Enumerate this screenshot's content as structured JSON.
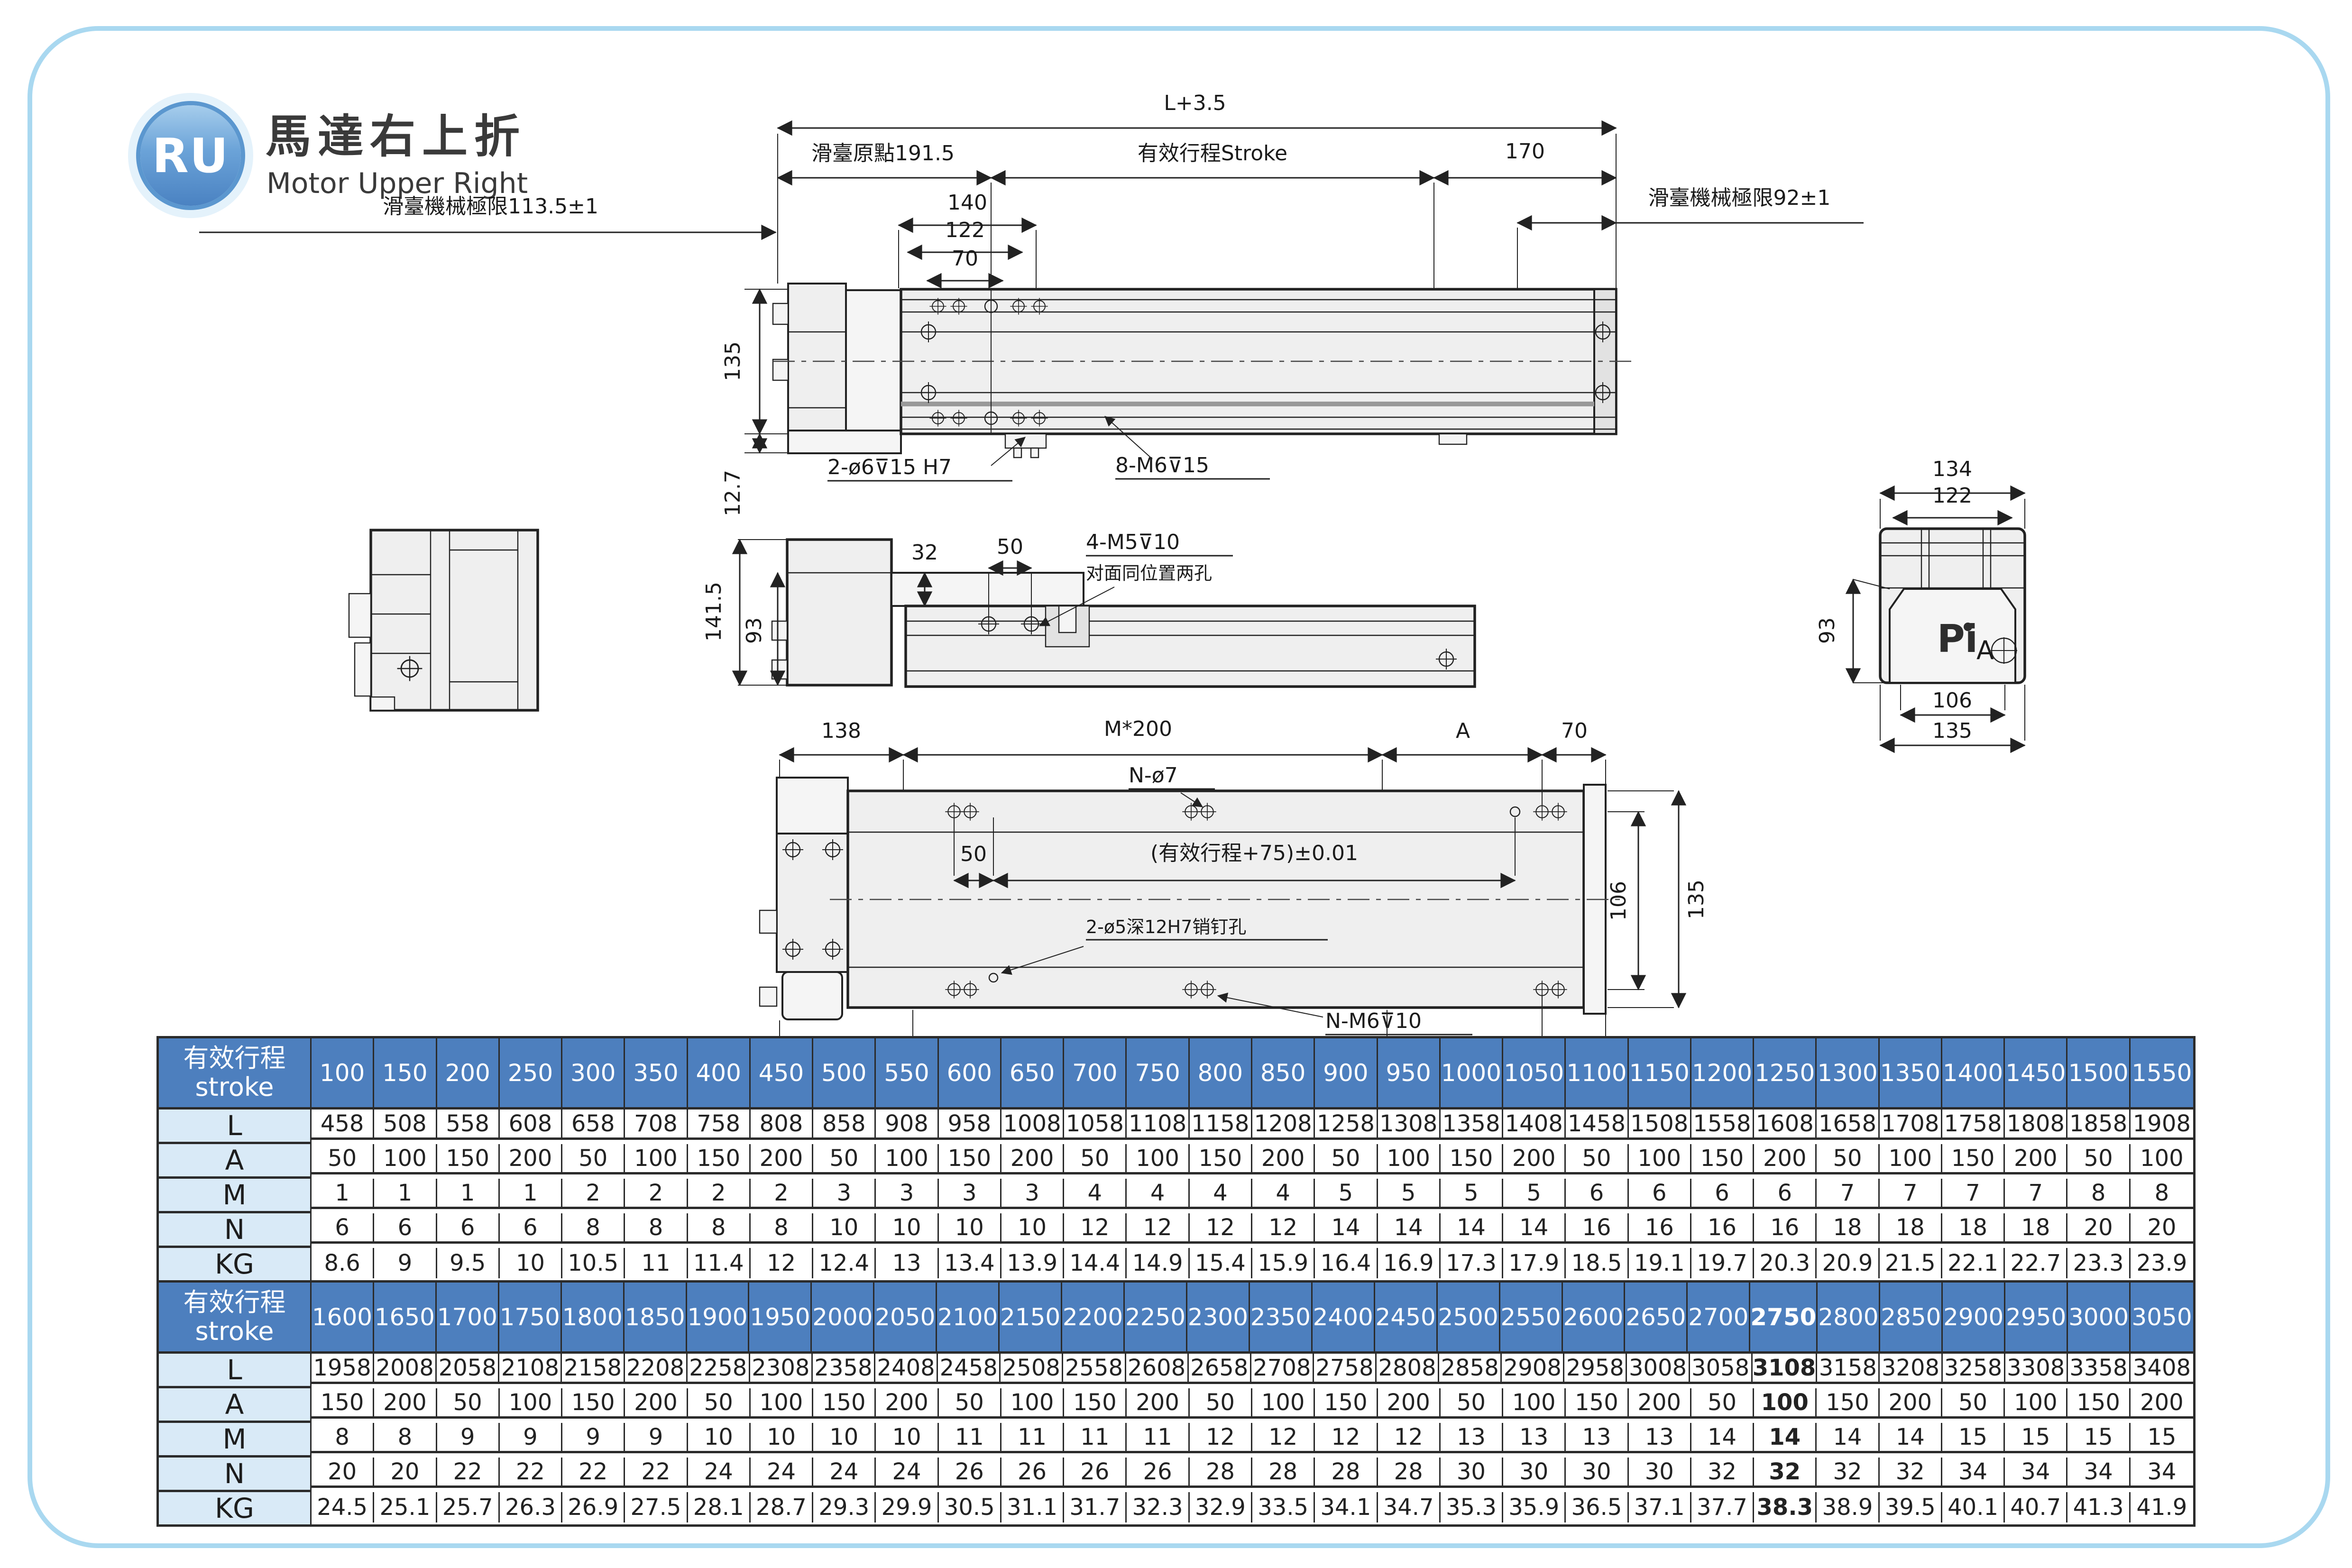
{
  "header": {
    "logo": "RU",
    "title_cn": "馬達右上折",
    "title_en": "Motor Upper Right"
  },
  "colors": {
    "accent_blue": "#4d7fbe",
    "row_label_bg": "#d9eaf7",
    "frame_border": "#a9d8f0",
    "line": "#222222"
  },
  "top_view": {
    "total": "L+3.5",
    "origin": "滑臺原點191.5",
    "stroke": "有效行程Stroke",
    "d170": "170",
    "d140": "140",
    "d122": "122",
    "d70": "70",
    "limit_left": "滑臺機械極限113.5±1",
    "limit_right": "滑臺機械極限92±1",
    "d135": "135",
    "d127": "12.7",
    "holes_dowel": "2-ø6⊽15 H7",
    "holes_tap": "8-M6⊽15"
  },
  "section_view": {
    "d1415": "141.5",
    "d93": "93",
    "d32": "32",
    "d50": "50",
    "tap": "4-M5⊽10",
    "tap_note": "对面同位置两孔"
  },
  "right_view": {
    "d134": "134",
    "d122": "122",
    "d93": "93",
    "d106": "106",
    "d135": "135",
    "logo": "Pi",
    "datum": "A"
  },
  "bottom_view": {
    "d138": "138",
    "pitch_top": "M*200",
    "a_top": "A",
    "d70": "70",
    "holes": "N-ø7",
    "d50": "50",
    "stroke_tol": "(有效行程+75)±0.01",
    "pin": "2-ø5深12H7销钉孔",
    "d148": "148",
    "pitch_bottom": "M*200",
    "tap": "N-M6⊽10",
    "a_bottom": "A",
    "d60": "60",
    "d106": "106",
    "d135": "135"
  },
  "tables": [
    {
      "title_cn": "有效行程",
      "title_en": "stroke",
      "highlight_index": -1,
      "strokes": [
        "100",
        "150",
        "200",
        "250",
        "300",
        "350",
        "400",
        "450",
        "500",
        "550",
        "600",
        "650",
        "700",
        "750",
        "800",
        "850",
        "900",
        "950",
        "1000",
        "1050",
        "1100",
        "1150",
        "1200",
        "1250",
        "1300",
        "1350",
        "1400",
        "1450",
        "1500",
        "1550"
      ],
      "rows": [
        {
          "label": "L",
          "values": [
            "458",
            "508",
            "558",
            "608",
            "658",
            "708",
            "758",
            "808",
            "858",
            "908",
            "958",
            "1008",
            "1058",
            "1108",
            "1158",
            "1208",
            "1258",
            "1308",
            "1358",
            "1408",
            "1458",
            "1508",
            "1558",
            "1608",
            "1658",
            "1708",
            "1758",
            "1808",
            "1858",
            "1908"
          ]
        },
        {
          "label": "A",
          "values": [
            "50",
            "100",
            "150",
            "200",
            "50",
            "100",
            "150",
            "200",
            "50",
            "100",
            "150",
            "200",
            "50",
            "100",
            "150",
            "200",
            "50",
            "100",
            "150",
            "200",
            "50",
            "100",
            "150",
            "200",
            "50",
            "100",
            "150",
            "200",
            "50",
            "100"
          ]
        },
        {
          "label": "M",
          "values": [
            "1",
            "1",
            "1",
            "1",
            "2",
            "2",
            "2",
            "2",
            "3",
            "3",
            "3",
            "3",
            "4",
            "4",
            "4",
            "4",
            "5",
            "5",
            "5",
            "5",
            "6",
            "6",
            "6",
            "6",
            "7",
            "7",
            "7",
            "7",
            "8",
            "8"
          ]
        },
        {
          "label": "N",
          "values": [
            "6",
            "6",
            "6",
            "6",
            "8",
            "8",
            "8",
            "8",
            "10",
            "10",
            "10",
            "10",
            "12",
            "12",
            "12",
            "12",
            "14",
            "14",
            "14",
            "14",
            "16",
            "16",
            "16",
            "16",
            "18",
            "18",
            "18",
            "18",
            "20",
            "20"
          ]
        },
        {
          "label": "KG",
          "values": [
            "8.6",
            "9",
            "9.5",
            "10",
            "10.5",
            "11",
            "11.4",
            "12",
            "12.4",
            "13",
            "13.4",
            "13.9",
            "14.4",
            "14.9",
            "15.4",
            "15.9",
            "16.4",
            "16.9",
            "17.3",
            "17.9",
            "18.5",
            "19.1",
            "19.7",
            "20.3",
            "20.9",
            "21.5",
            "22.1",
            "22.7",
            "23.3",
            "23.9"
          ]
        }
      ]
    },
    {
      "title_cn": "有效行程",
      "title_en": "stroke",
      "highlight_index": 23,
      "strokes": [
        "1600",
        "1650",
        "1700",
        "1750",
        "1800",
        "1850",
        "1900",
        "1950",
        "2000",
        "2050",
        "2100",
        "2150",
        "2200",
        "2250",
        "2300",
        "2350",
        "2400",
        "2450",
        "2500",
        "2550",
        "2600",
        "2650",
        "2700",
        "2750",
        "2800",
        "2850",
        "2900",
        "2950",
        "3000",
        "3050"
      ],
      "rows": [
        {
          "label": "L",
          "values": [
            "1958",
            "2008",
            "2058",
            "2108",
            "2158",
            "2208",
            "2258",
            "2308",
            "2358",
            "2408",
            "2458",
            "2508",
            "2558",
            "2608",
            "2658",
            "2708",
            "2758",
            "2808",
            "2858",
            "2908",
            "2958",
            "3008",
            "3058",
            "3108",
            "3158",
            "3208",
            "3258",
            "3308",
            "3358",
            "3408"
          ]
        },
        {
          "label": "A",
          "values": [
            "150",
            "200",
            "50",
            "100",
            "150",
            "200",
            "50",
            "100",
            "150",
            "200",
            "50",
            "100",
            "150",
            "200",
            "50",
            "100",
            "150",
            "200",
            "50",
            "100",
            "150",
            "200",
            "50",
            "100",
            "150",
            "200",
            "50",
            "100",
            "150",
            "200"
          ]
        },
        {
          "label": "M",
          "values": [
            "8",
            "8",
            "9",
            "9",
            "9",
            "9",
            "10",
            "10",
            "10",
            "10",
            "11",
            "11",
            "11",
            "11",
            "12",
            "12",
            "12",
            "12",
            "13",
            "13",
            "13",
            "13",
            "14",
            "14",
            "14",
            "14",
            "15",
            "15",
            "15",
            "15"
          ]
        },
        {
          "label": "N",
          "values": [
            "20",
            "20",
            "22",
            "22",
            "22",
            "22",
            "24",
            "24",
            "24",
            "24",
            "26",
            "26",
            "26",
            "26",
            "28",
            "28",
            "28",
            "28",
            "30",
            "30",
            "30",
            "30",
            "32",
            "32",
            "32",
            "32",
            "34",
            "34",
            "34",
            "34"
          ]
        },
        {
          "label": "KG",
          "values": [
            "24.5",
            "25.1",
            "25.7",
            "26.3",
            "26.9",
            "27.5",
            "28.1",
            "28.7",
            "29.3",
            "29.9",
            "30.5",
            "31.1",
            "31.7",
            "32.3",
            "32.9",
            "33.5",
            "34.1",
            "34.7",
            "35.3",
            "35.9",
            "36.5",
            "37.1",
            "37.7",
            "38.3",
            "38.9",
            "39.5",
            "40.1",
            "40.7",
            "41.3",
            "41.9"
          ]
        }
      ]
    }
  ]
}
